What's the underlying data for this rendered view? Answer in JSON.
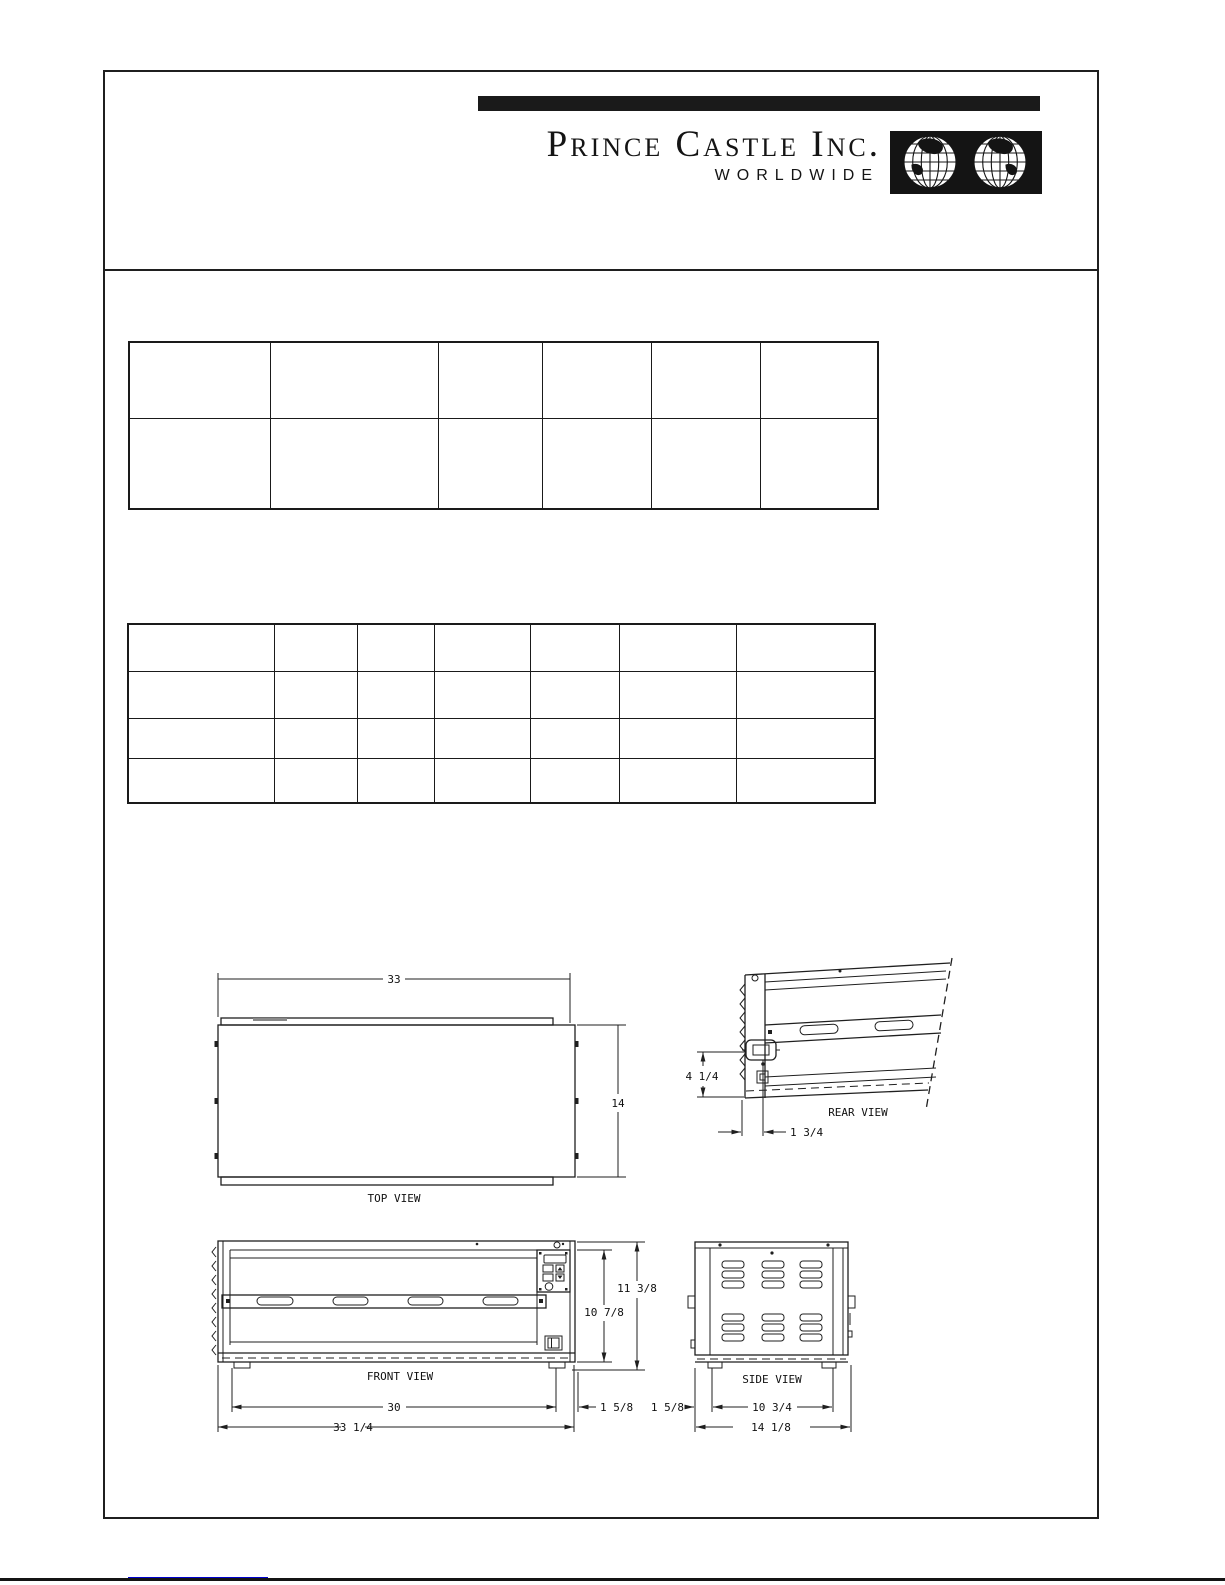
{
  "header": {
    "brand_name": "Prince Castle Inc.",
    "tagline": "WORLDWIDE",
    "logo_icon": "globe-grid-icon",
    "brand_color": "#1a1a1a"
  },
  "spec_tables": {
    "upper": {
      "row_count": 2,
      "column_count": 6
    },
    "lower": {
      "row_count": 4,
      "column_count": 7
    }
  },
  "drawings": {
    "top_view": {
      "label": "TOP VIEW",
      "width_dim": "33",
      "depth_dim": "14"
    },
    "rear_view": {
      "label": "REAR VIEW",
      "outlet_height_dim": "4 1/4",
      "outlet_offset_dim": "1 3/4"
    },
    "front_view": {
      "label": "FRONT VIEW",
      "overall_height_dim": "11 3/8",
      "body_height_dim": "10 7/8",
      "inner_width_dim": "30",
      "overall_width_dim": "33 1/4",
      "right_inset_dim": "1 5/8"
    },
    "side_view": {
      "label": "SIDE VIEW",
      "left_inset_dim": "1 5/8",
      "foot_span_dim": "10 3/4",
      "overall_depth_dim": "14 1/8"
    }
  },
  "footer": {
    "link_color": "#0000cc"
  }
}
